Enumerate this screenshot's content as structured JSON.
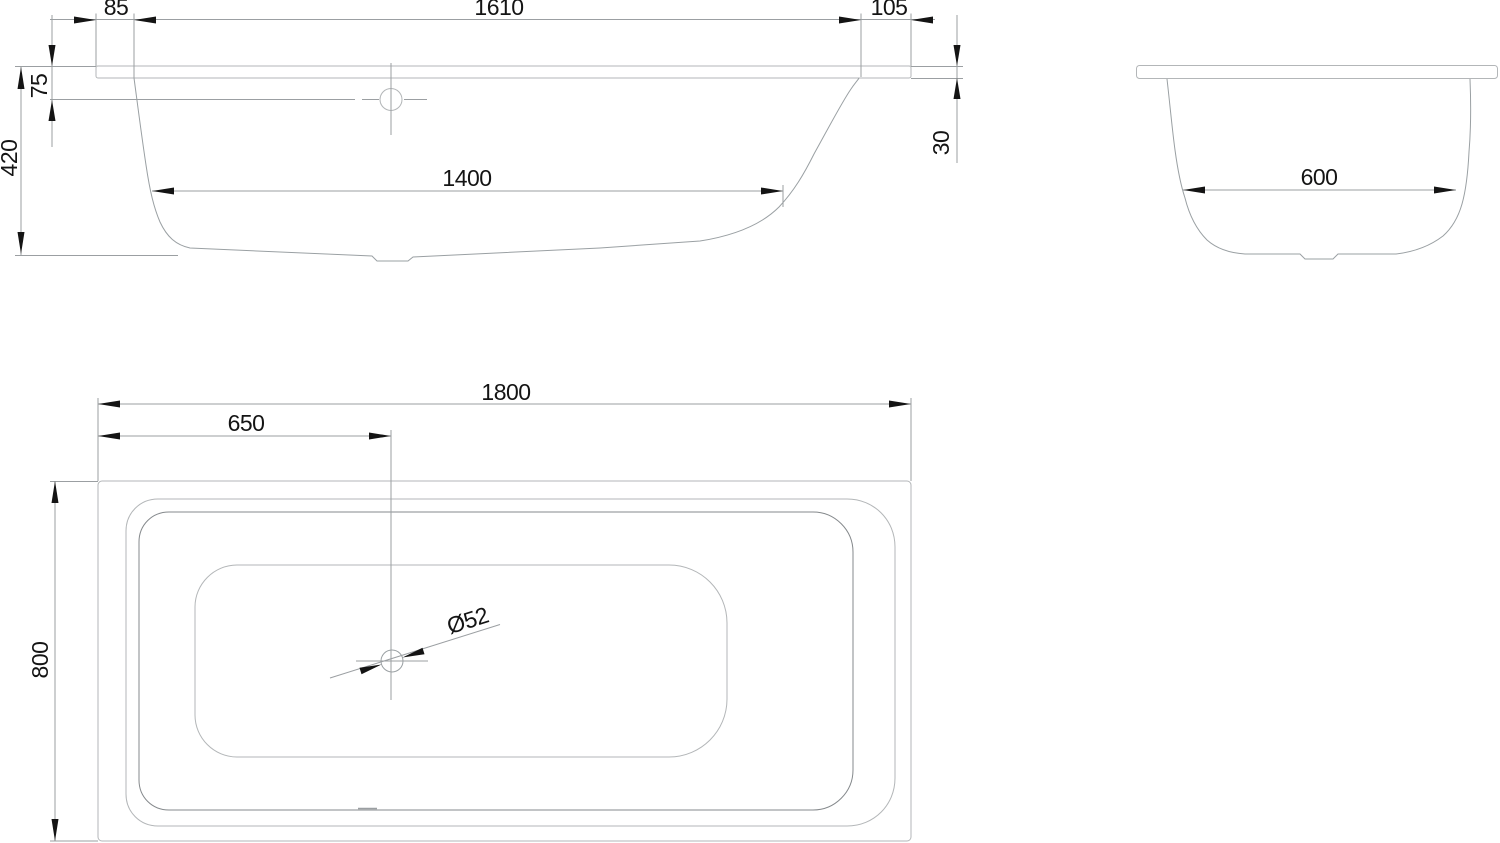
{
  "drawing": {
    "type": "bathtub technical drawing, three orthographic views",
    "colors": {
      "background": "#ffffff",
      "geometry_line": "#b3b6b8",
      "shell_line": "#9aa0a3",
      "inner_edge_line": "#85898c",
      "dimension_line": "#9b9fa2",
      "text_and_arrows": "#141414"
    },
    "views": {
      "side_view": {
        "name": "side elevation",
        "dims": {
          "rim_flat_left": "85",
          "top_opening": "1610",
          "rim_flat_right": "105",
          "overflow_drop": "75",
          "overall_height": "420",
          "bottom_length": "1400",
          "rim_height": "30"
        }
      },
      "end_view": {
        "name": "end elevation",
        "dims": {
          "bottom_width": "600"
        }
      },
      "plan_view": {
        "name": "plan view",
        "dims": {
          "overall_length": "1800",
          "drain_offset": "650",
          "overall_width": "800",
          "drain_diameter": "Ø52"
        }
      }
    }
  }
}
